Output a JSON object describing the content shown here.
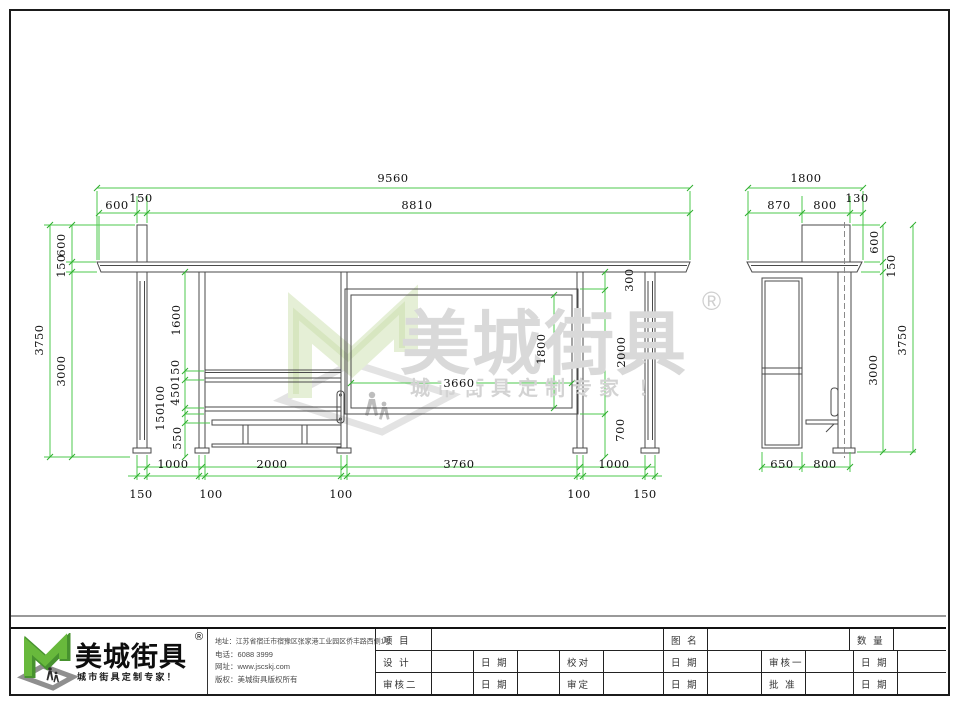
{
  "watermark": {
    "brand": "美城街具",
    "reg": "®",
    "tagline": "城市街具定制专家 ！"
  },
  "front_view": {
    "top": {
      "total": "9560",
      "inner": "8810",
      "offset": "600",
      "post": "150"
    },
    "left_outer": {
      "overall": "3750",
      "above_roof": "600",
      "roof": "150",
      "below_roof": "3000"
    },
    "left_inner": {
      "a": "1600",
      "b": "150",
      "c": "450",
      "d": "100",
      "e": "150",
      "f": "550"
    },
    "right": {
      "gap": "300",
      "panel_zone": "2000",
      "lower": "700"
    },
    "panel": {
      "width": "3660",
      "height": "1800"
    },
    "bottom_spans": [
      "1000",
      "2000",
      "3760",
      "1000"
    ],
    "column_widths": [
      "150",
      "100",
      "100",
      "100",
      "150"
    ]
  },
  "side_view": {
    "top": {
      "total": "1800",
      "a": "870",
      "b": "800",
      "c": "130"
    },
    "right": {
      "above_roof": "600",
      "roof": "150",
      "below_roof": "3000",
      "overall": "3750"
    },
    "bottom": {
      "a": "650",
      "b": "800"
    }
  },
  "titleblock": {
    "logo": {
      "brand": "美城街具",
      "reg": "®",
      "tagline": "城市街具定制专家！"
    },
    "info": {
      "address": "地址：江苏省宿迁市宿豫区张家港工业园区侨丰路西侧1号",
      "phone": "电话：6088 3999",
      "web": "网址：www.jscskj.com",
      "copyright": "版权：美城街具版权所有"
    },
    "table": {
      "row1": {
        "c1": "项 目",
        "c2": "图 名",
        "c3": "数 量"
      },
      "row2": {
        "c1": "设 计",
        "c2": "日 期",
        "c3": "校对",
        "c4": "日 期",
        "c5": "审核一",
        "c6": "日 期"
      },
      "row3": {
        "c1": "审核二",
        "c2": "日 期",
        "c3": "审定",
        "c4": "日 期",
        "c5": "批 准",
        "c6": "日 期"
      }
    }
  },
  "colors": {
    "dimension_green": "#4ec94e",
    "logo_green": "#68b93c",
    "logo_green_dark": "#47922f",
    "line_gray": "#4a4a4a"
  }
}
